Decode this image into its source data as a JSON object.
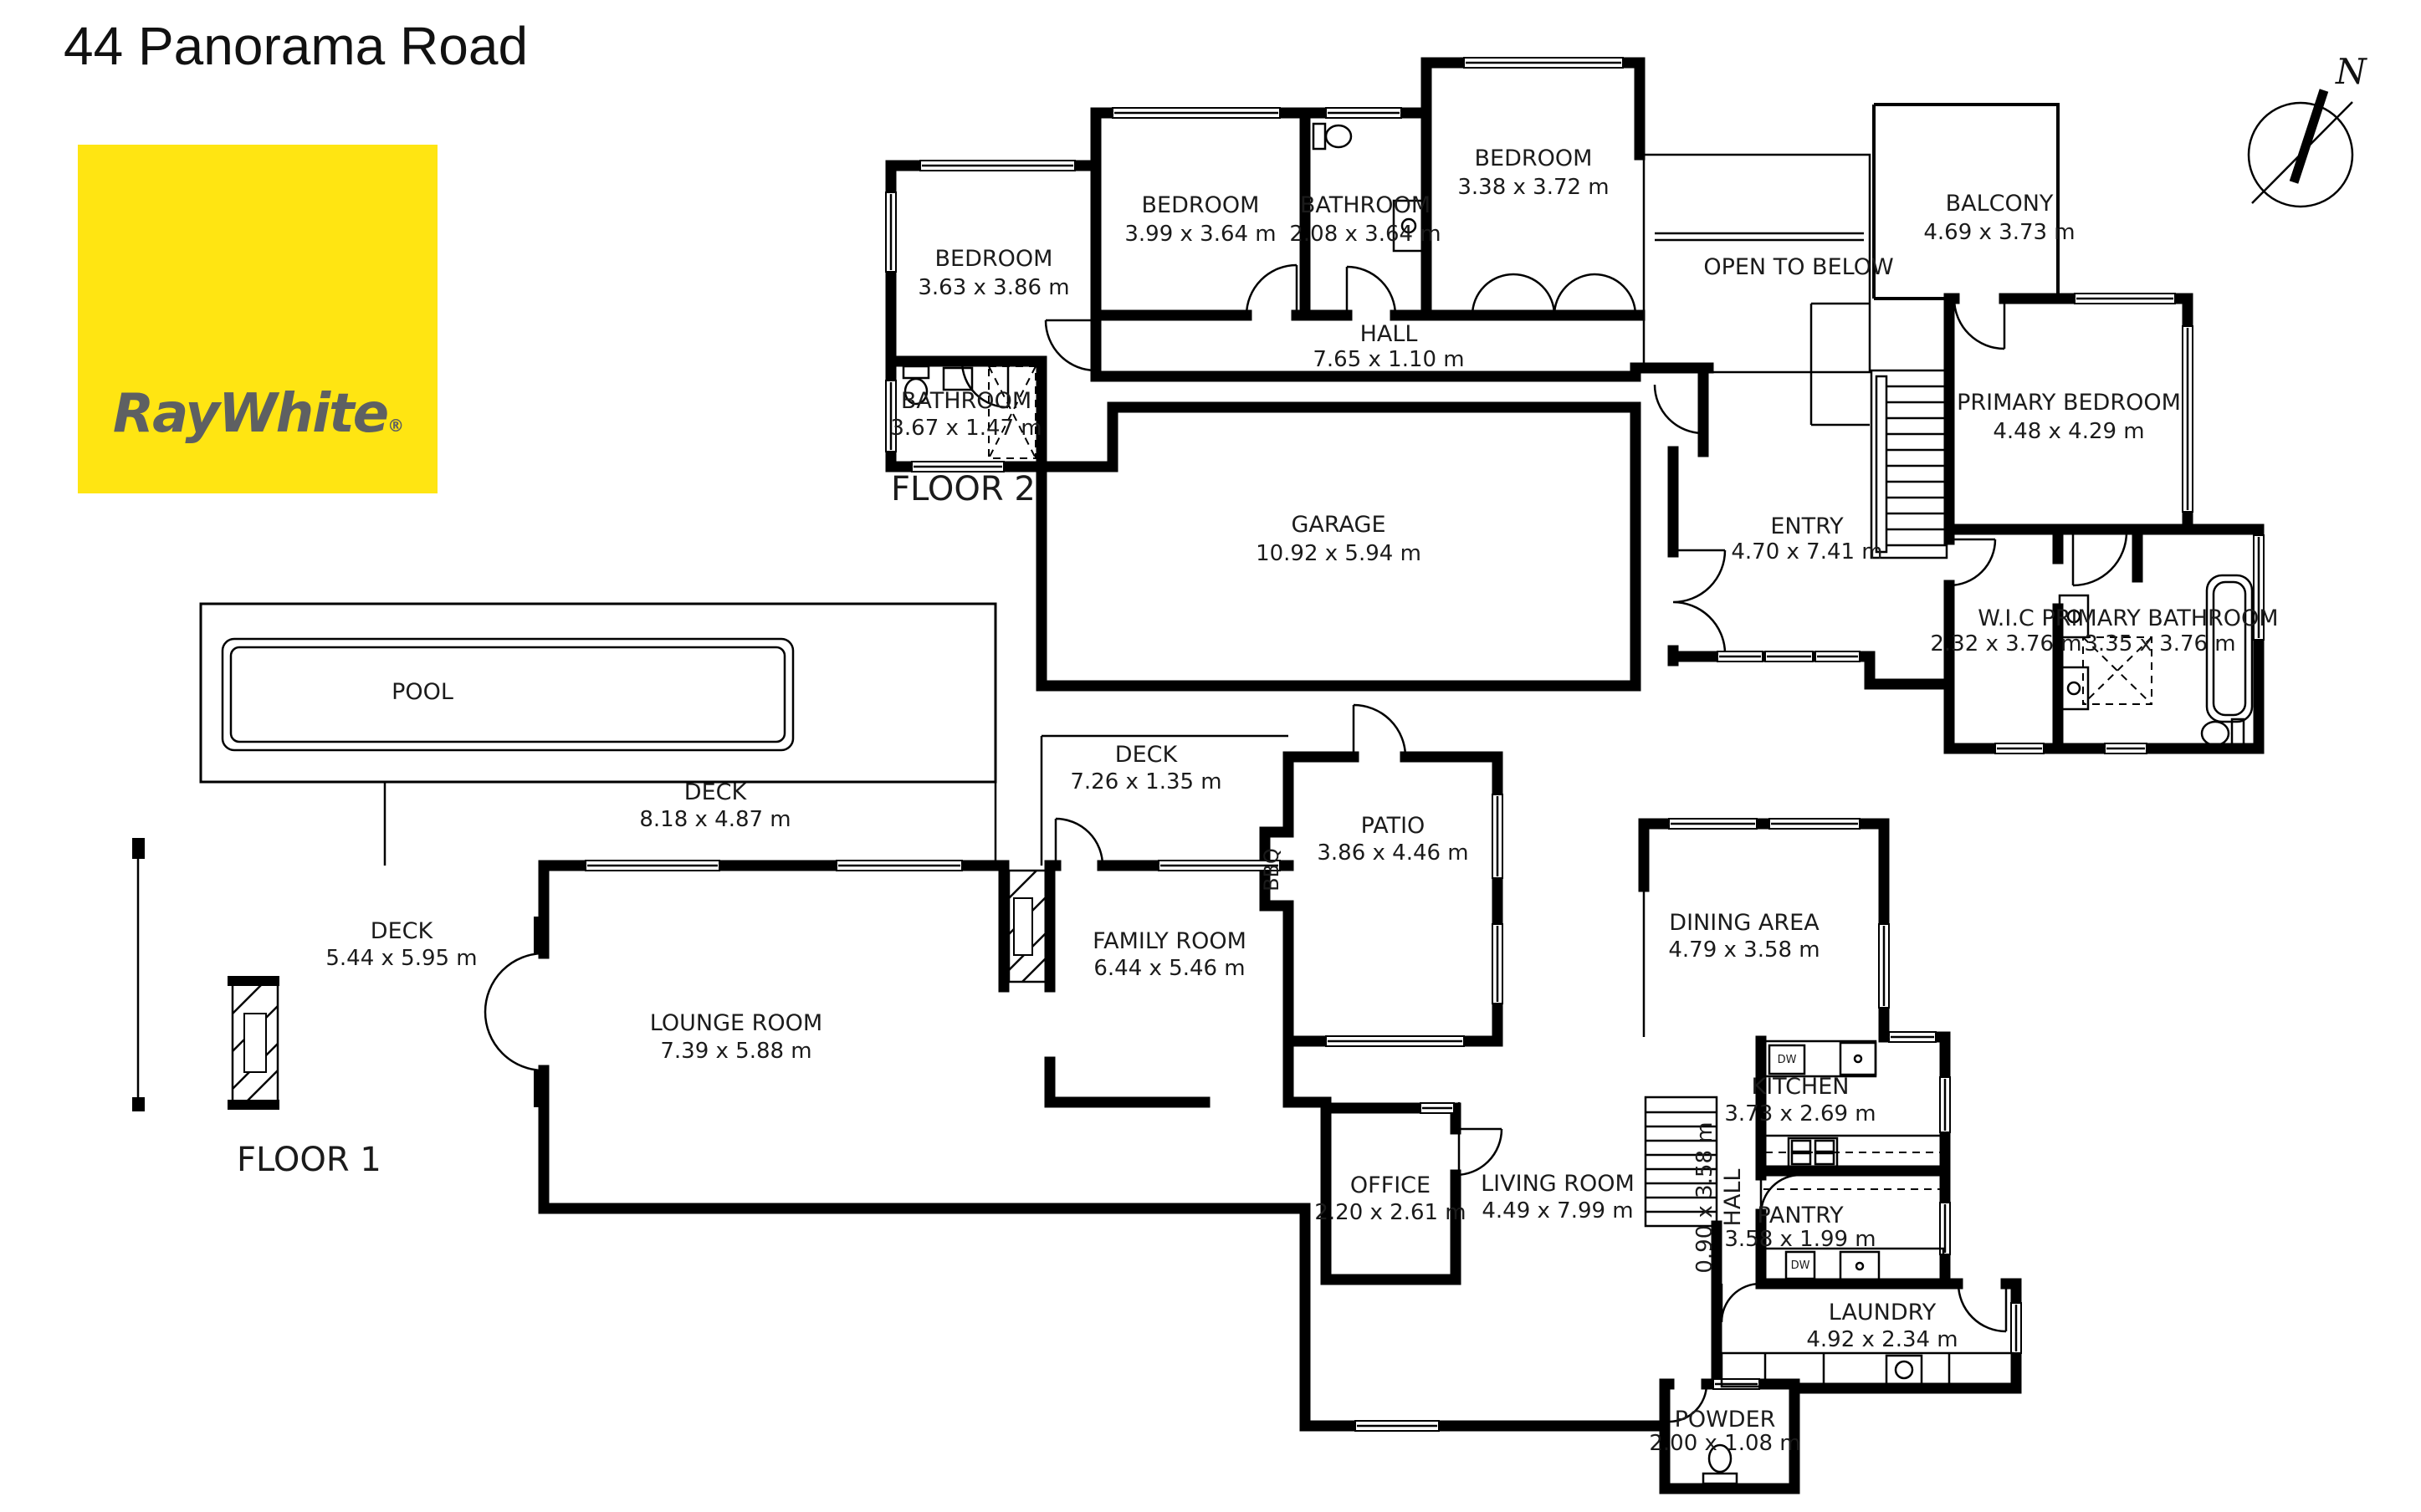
{
  "page": {
    "title": "44 Panorama Road"
  },
  "brand": {
    "name": "RayWhite",
    "registered": "®",
    "bg_color": "#FFE512",
    "text_color": "#5E6062"
  },
  "compass": {
    "north": "N"
  },
  "floor2": {
    "label": "FLOOR 2",
    "rooms": {
      "bedroom_left": {
        "name": "BEDROOM",
        "dims": "3.63 x 3.86 m"
      },
      "bedroom_mid": {
        "name": "BEDROOM",
        "dims": "3.99 x 3.64 m"
      },
      "bathroom_mid": {
        "name": "BATHROOM",
        "dims": "2.08 x 3.64 m"
      },
      "bedroom_right": {
        "name": "BEDROOM",
        "dims": "3.38 x 3.72 m"
      },
      "hall": {
        "name": "HALL",
        "dims": "7.65 x 1.10 m"
      },
      "bathroom_left": {
        "name": "BATHROOM",
        "dims": "3.67 x 1.47 m"
      },
      "garage": {
        "name": "GARAGE",
        "dims": "10.92 x 5.94 m"
      },
      "entry": {
        "name": "ENTRY",
        "dims": "4.70 x 7.41 m"
      },
      "open_to_below": {
        "name": "OPEN TO BELOW"
      },
      "balcony": {
        "name": "BALCONY",
        "dims": "4.69 x 3.73 m"
      },
      "primary_bedroom": {
        "name": "PRIMARY BEDROOM",
        "dims": "4.48 x 4.29 m"
      },
      "wic": {
        "name": "W.I.C",
        "dims": "2.32 x 3.76 m"
      },
      "primary_bathroom": {
        "name": "PRIMARY BATHROOM",
        "dims": "3.35 x 3.76 m"
      }
    }
  },
  "floor1": {
    "label": "FLOOR 1",
    "rooms": {
      "pool": {
        "name": "POOL"
      },
      "deck_upper": {
        "name": "DECK",
        "dims": "8.18 x 4.87 m"
      },
      "deck_left": {
        "name": "DECK",
        "dims": "5.44 x 5.95 m"
      },
      "deck_strip": {
        "name": "DECK",
        "dims": "7.26 x 1.35 m"
      },
      "patio": {
        "name": "PATIO",
        "dims": "3.86 x 4.46 m"
      },
      "bbq": {
        "name": "BBQ"
      },
      "family_room": {
        "name": "FAMILY ROOM",
        "dims": "6.44 x 5.46 m"
      },
      "lounge_room": {
        "name": "LOUNGE ROOM",
        "dims": "7.39 x 5.88 m"
      },
      "dining_area": {
        "name": "DINING AREA",
        "dims": "4.79 x 3.58 m"
      },
      "kitchen": {
        "name": "KITCHEN",
        "dims": "3.73 x 2.69 m"
      },
      "hall": {
        "name": "HALL",
        "dims": "0.90 x 3.58 m"
      },
      "office": {
        "name": "OFFICE",
        "dims": "2.20 x 2.61 m"
      },
      "living_room": {
        "name": "LIVING ROOM",
        "dims": "4.49 x 7.99 m"
      },
      "pantry": {
        "name": "PANTRY",
        "dims": "3.58 x 1.99 m"
      },
      "laundry": {
        "name": "LAUNDRY",
        "dims": "4.92 x 2.34 m"
      },
      "powder": {
        "name": "POWDER",
        "dims": "2.00 x 1.08 m"
      }
    }
  },
  "appliances": {
    "dishwasher": "DW"
  }
}
